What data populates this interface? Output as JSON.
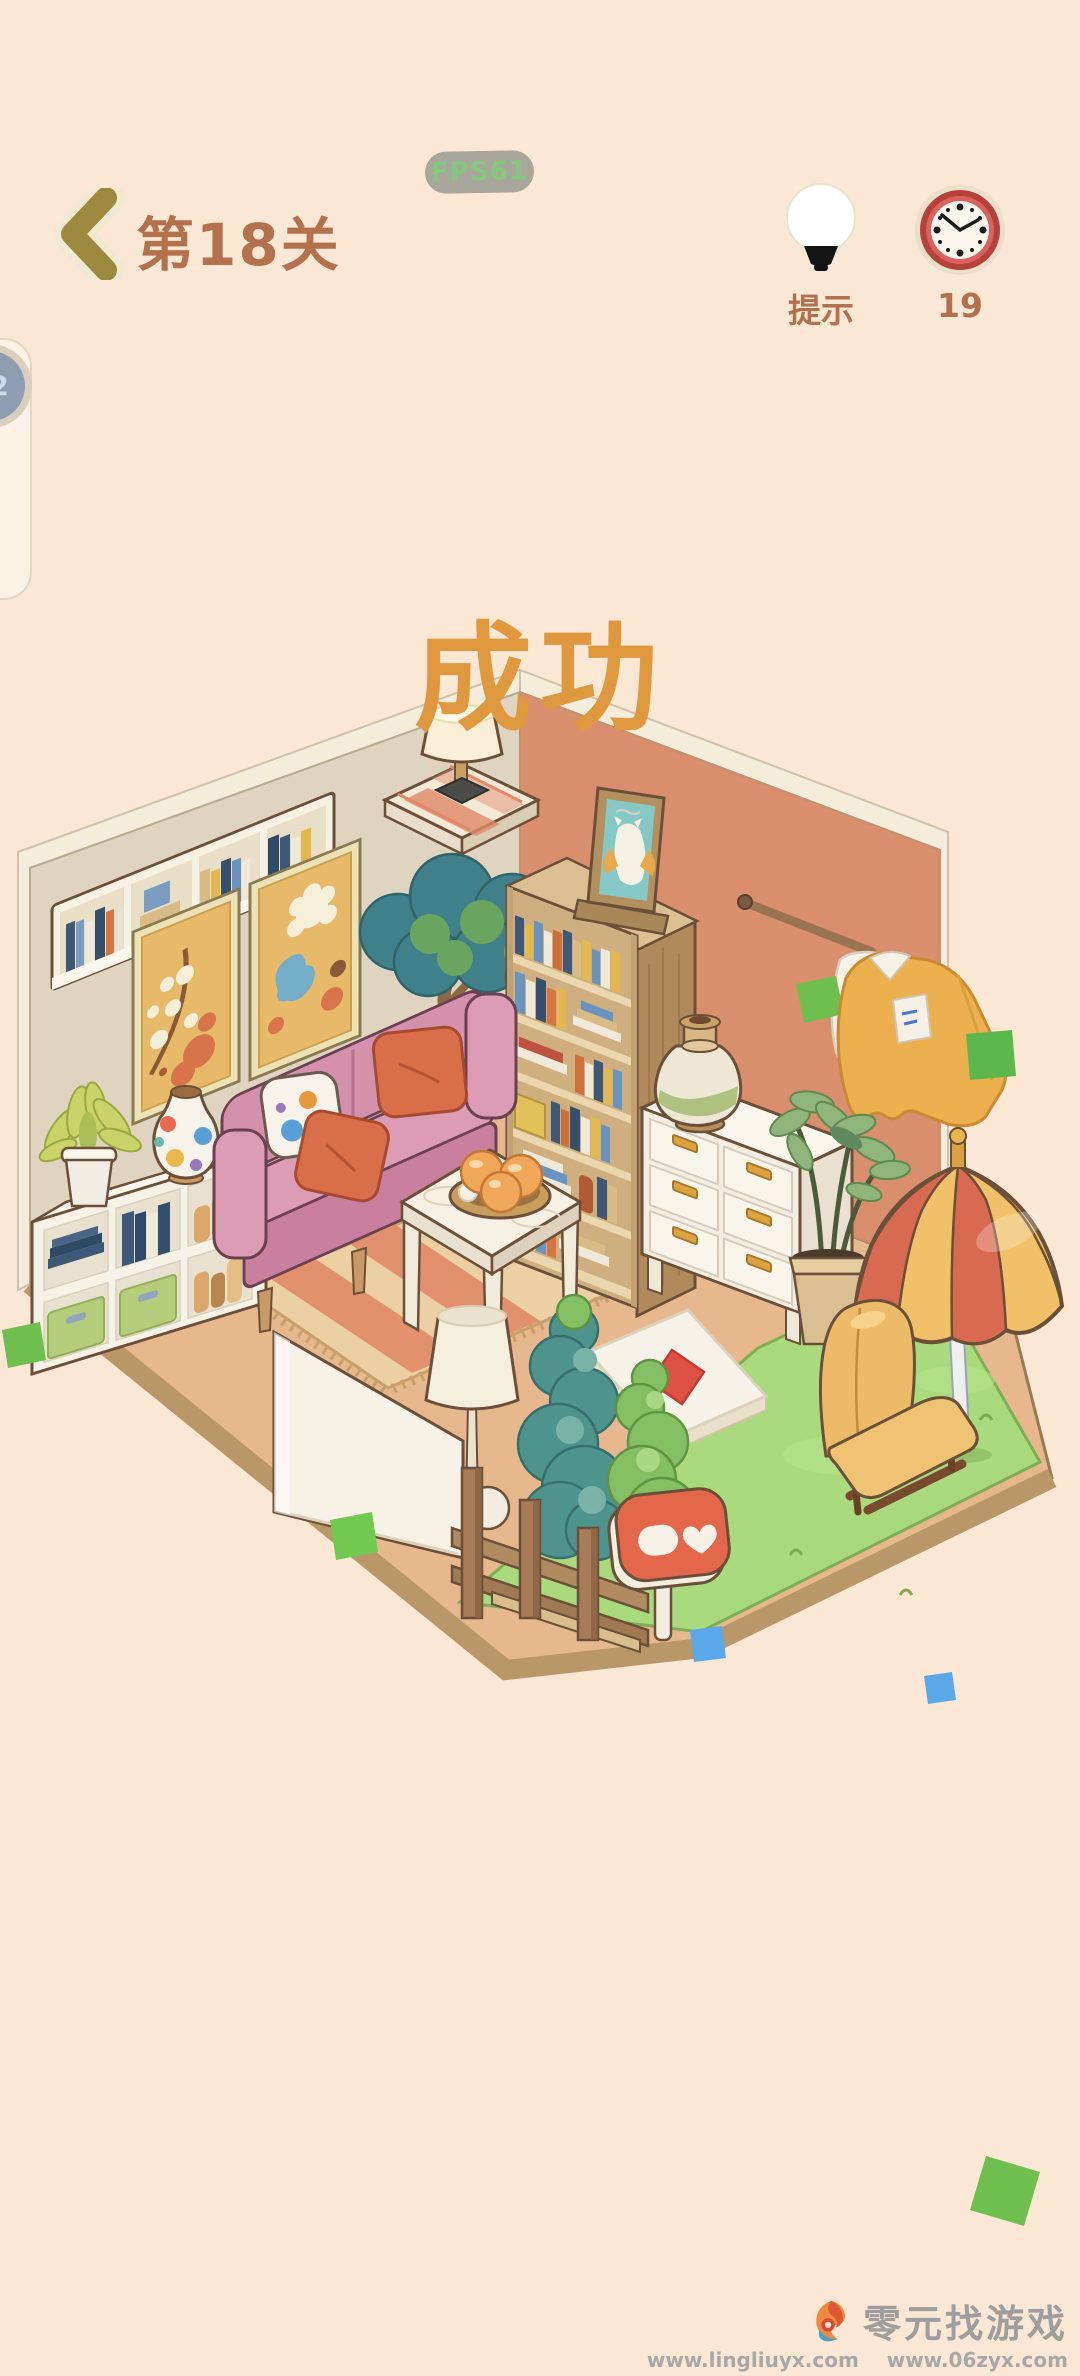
{
  "app": {
    "background_color": "#fae7d4"
  },
  "fps_badge": {
    "text": "FPS61",
    "bg_color": "#a9a79b",
    "text_color": "#85c97d"
  },
  "header": {
    "level_title": "第18关",
    "title_color": "#b4714e",
    "hint_button": {
      "label": "提示"
    },
    "timer_button": {
      "count": "19"
    }
  },
  "success_overlay": {
    "text": "成功",
    "color": "#e0983e"
  },
  "side_float": {
    "badge_count": "22"
  },
  "watermark": {
    "site_name": "零元找游戏",
    "url_primary": "www.lingliuyx.com",
    "url_secondary": "www.06zyx.com"
  },
  "scene": {
    "palette": {
      "left_wall": "#ded4c0",
      "right_wall": "#d98e6d",
      "floor": "#e7b88d",
      "floor_edge": "#b99768",
      "grass": "#a9da7d",
      "rug": "#ecd0a4",
      "sofa_pink": "#d391ab",
      "pillow_orange": "#d96f4a",
      "umbrella_red": "#d96a52",
      "umbrella_yellow": "#f0c168",
      "chair_yellow": "#ecba68",
      "wood": "#cfae7f",
      "white_furniture": "#f6f1e4",
      "tree_teal": "#4f938d",
      "tree_green": "#84c063",
      "confetti_green": "#6fbf4f",
      "confetti_blue": "#5aa8e8"
    }
  }
}
